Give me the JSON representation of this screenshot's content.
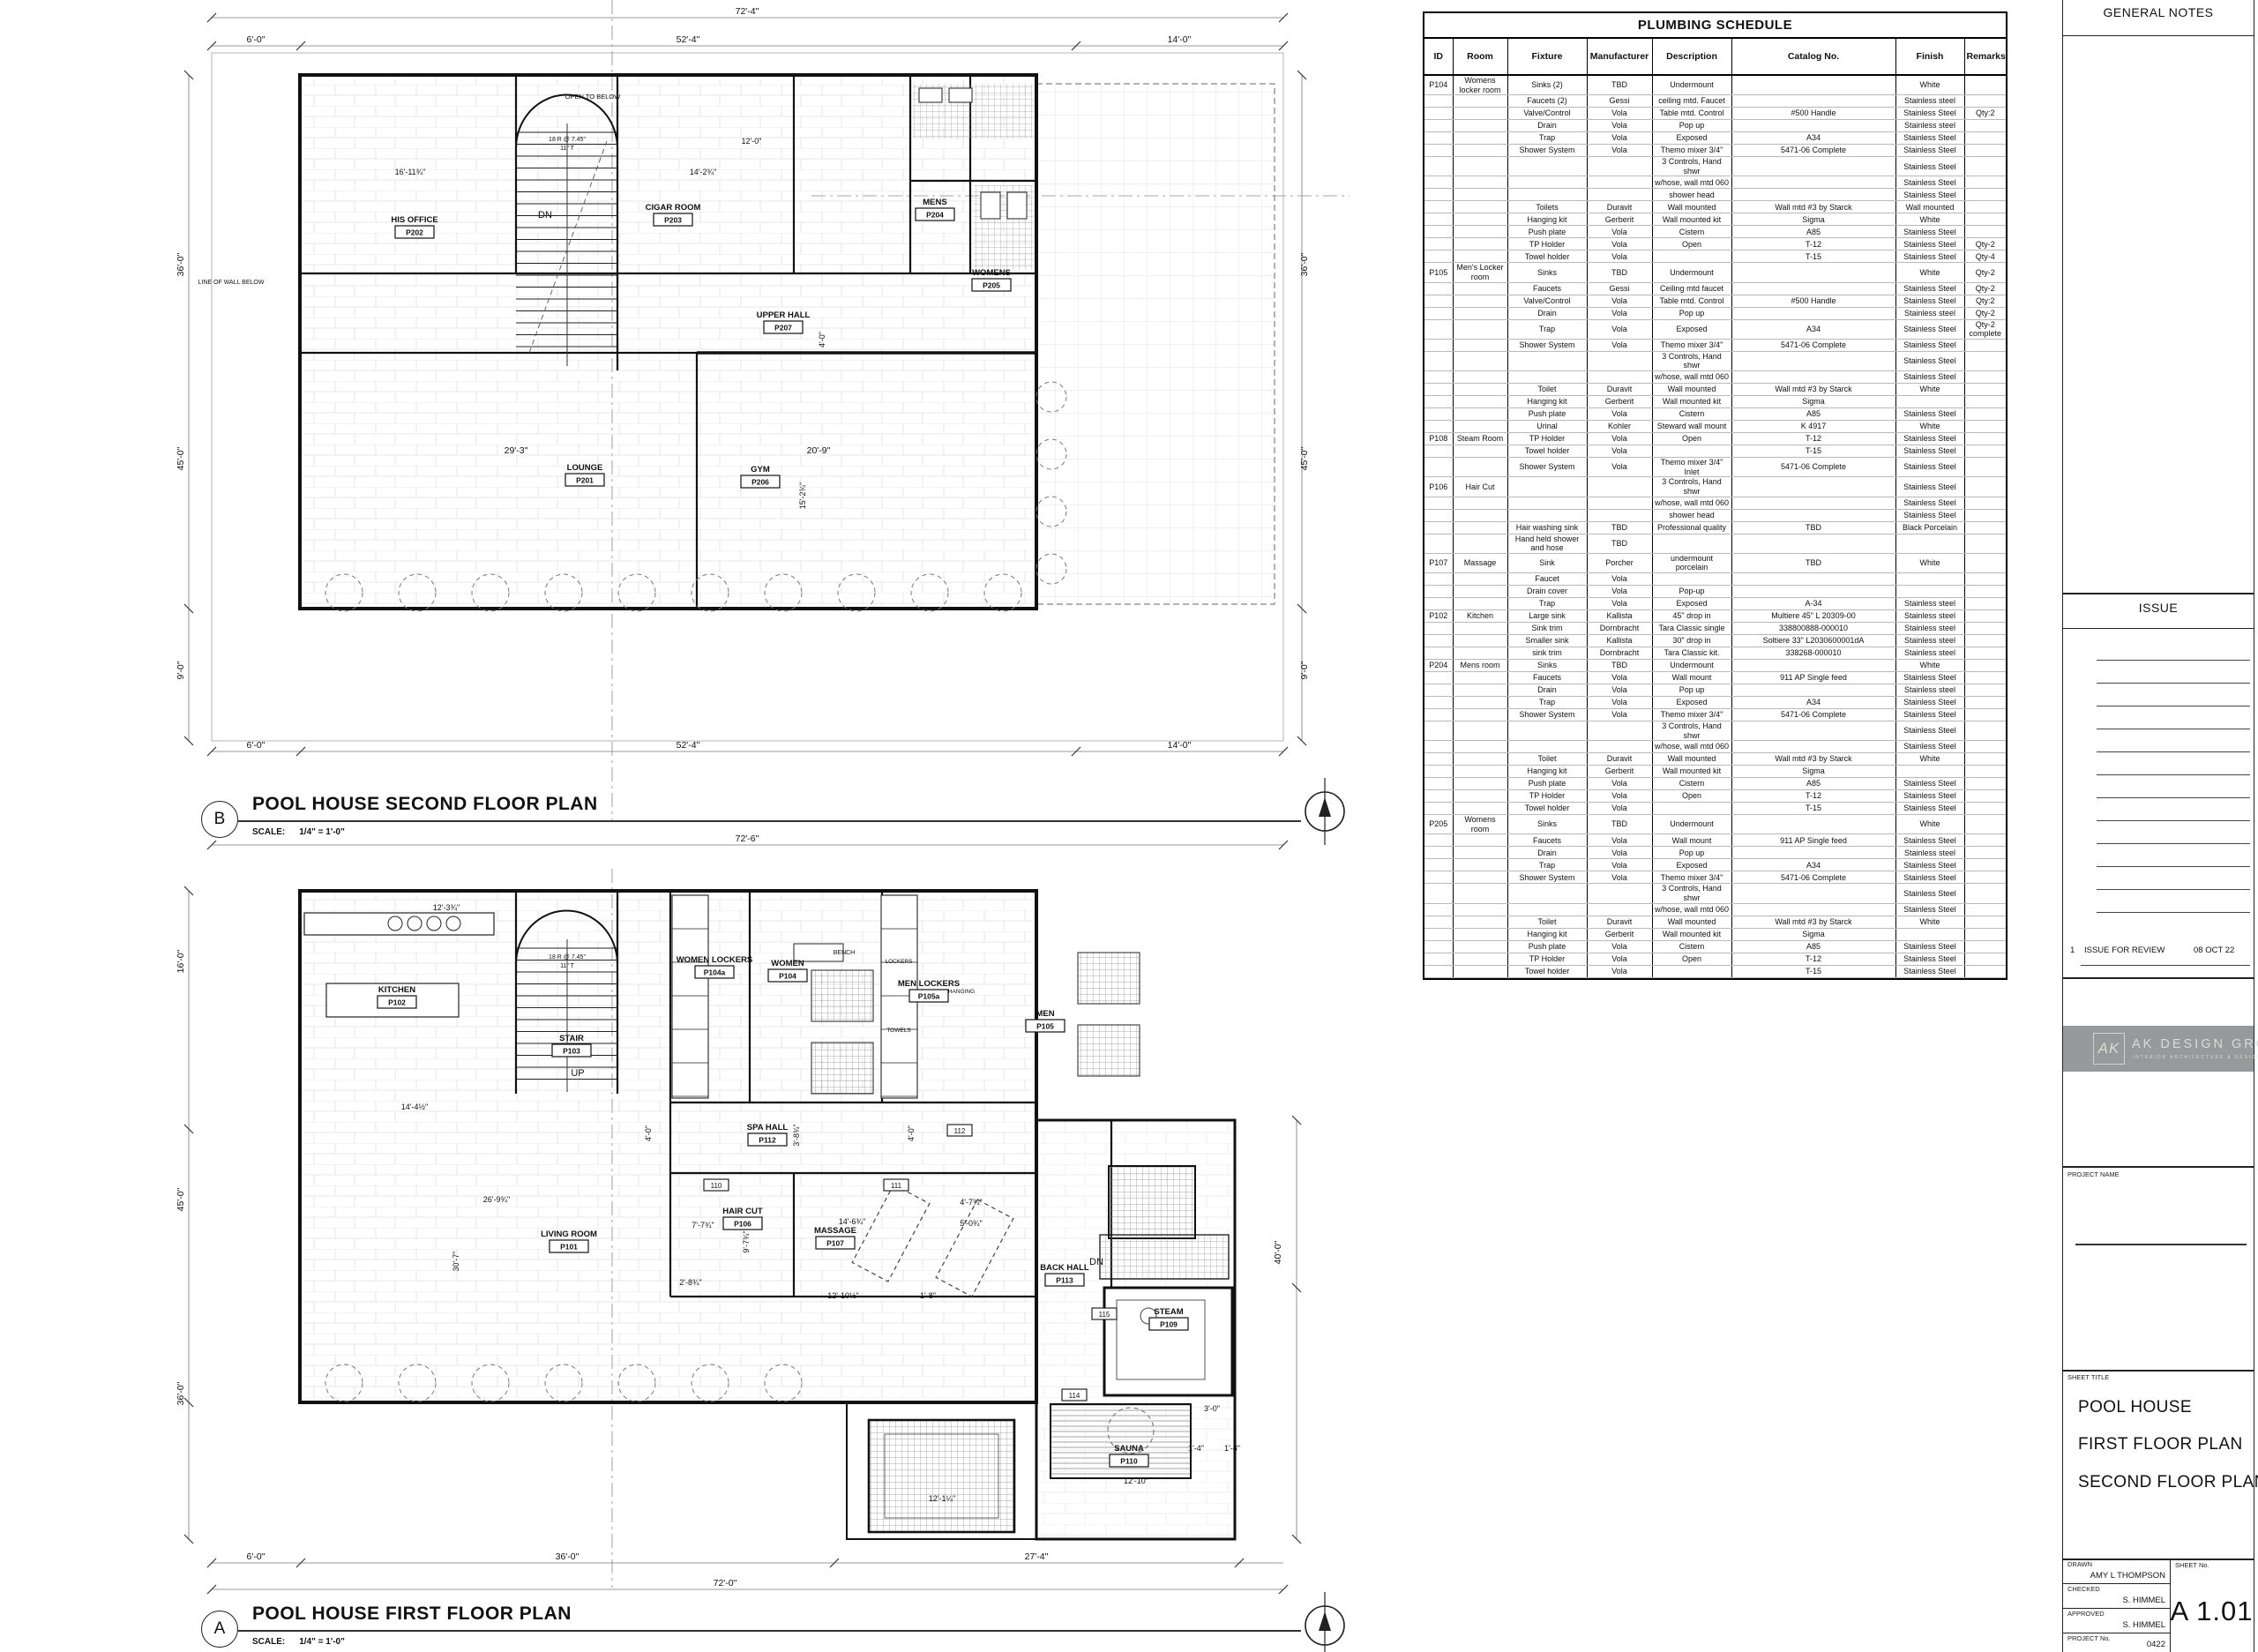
{
  "schedule": {
    "title": "PLUMBING SCHEDULE",
    "columns": [
      "ID",
      "Room",
      "Fixture",
      "Manufacturer",
      "Description",
      "Catalog No.",
      "Finish",
      "Remarks"
    ],
    "rows": [
      {
        "g": 1,
        "id": "P104",
        "room": "Womens locker room",
        "fixture": "Sinks (2)",
        "mfr": "TBD",
        "desc": "Undermount",
        "cat": "",
        "fin": "White",
        "rem": ""
      },
      {
        "fixture": "Faucets (2)",
        "mfr": "Gessi",
        "desc": "ceiling mtd. Faucet",
        "cat": "",
        "fin": "Stainless steel",
        "rem": ""
      },
      {
        "fixture": "Valve/Control",
        "mfr": "Vola",
        "desc": "Table mtd. Control",
        "cat": "#500 Handle",
        "fin": "Stainless Steel",
        "rem": "Qty:2"
      },
      {
        "fixture": "Drain",
        "mfr": "Vola",
        "desc": "Pop up",
        "cat": "",
        "fin": "Stainless steel",
        "rem": ""
      },
      {
        "fixture": "Trap",
        "mfr": "Vola",
        "desc": "Exposed",
        "cat": "A34",
        "fin": "Stainless Steel",
        "rem": ""
      },
      {
        "fixture": "Shower System",
        "mfr": "Vola",
        "desc": "Themo mixer 3/4\"",
        "cat": "5471-06 Complete",
        "fin": "Stainless Steel",
        "rem": ""
      },
      {
        "fixture": "",
        "mfr": "",
        "desc": "3 Controls, Hand shwr",
        "cat": "",
        "fin": "Stainless Steel",
        "rem": ""
      },
      {
        "fixture": "",
        "mfr": "",
        "desc": "w/hose, wall mtd 060",
        "cat": "",
        "fin": "Stainless Steel",
        "rem": ""
      },
      {
        "fixture": "",
        "mfr": "",
        "desc": "shower head",
        "cat": "",
        "fin": "Stainless Steel",
        "rem": ""
      },
      {
        "fixture": "Toilets",
        "mfr": "Duravit",
        "desc": "Wall mounted",
        "cat": "Wall mtd #3 by Starck",
        "fin": "Wall mounted",
        "rem": ""
      },
      {
        "fixture": "Hanging kit",
        "mfr": "Gerberit",
        "desc": "Wall mounted kit",
        "cat": "Sigma",
        "fin": "White",
        "rem": ""
      },
      {
        "fixture": "Push plate",
        "mfr": "Vola",
        "desc": "Cistern",
        "cat": "A85",
        "fin": "Stainless Steel",
        "rem": ""
      },
      {
        "fixture": "TP Holder",
        "mfr": "Vola",
        "desc": "Open",
        "cat": "T-12",
        "fin": "Stainless Steel",
        "rem": "Qty-2"
      },
      {
        "fixture": "Towel holder",
        "mfr": "Vola",
        "desc": "",
        "cat": "T-15",
        "fin": "Stainless Steel",
        "rem": "Qty-4"
      },
      {
        "g": 1,
        "id": "P105",
        "room": "Men's Locker room",
        "fixture": "Sinks",
        "mfr": "TBD",
        "desc": "Undermount",
        "cat": "",
        "fin": "White",
        "rem": "Qty-2"
      },
      {
        "fixture": "Faucets",
        "mfr": "Gessi",
        "desc": "Ceiling mtd faucet",
        "cat": "",
        "fin": "Stainless Steel",
        "rem": "Qty-2"
      },
      {
        "fixture": "Valve/Control",
        "mfr": "Vola",
        "desc": "Table mtd. Control",
        "cat": "#500 Handle",
        "fin": "Stainless Steel",
        "rem": "Qty:2"
      },
      {
        "fixture": "Drain",
        "mfr": "Vola",
        "desc": "Pop up",
        "cat": "",
        "fin": "Stainless steel",
        "rem": "Qty-2"
      },
      {
        "fixture": "Trap",
        "mfr": "Vola",
        "desc": "Exposed",
        "cat": "A34",
        "fin": "Stainless Steel",
        "rem": "Qty-2 complete"
      },
      {
        "fixture": "Shower System",
        "mfr": "Vola",
        "desc": "Themo mixer 3/4\"",
        "cat": "5471-06 Complete",
        "fin": "Stainless Steel",
        "rem": ""
      },
      {
        "fixture": "",
        "mfr": "",
        "desc": "3 Controls, Hand shwr",
        "cat": "",
        "fin": "Stainless Steel",
        "rem": ""
      },
      {
        "fixture": "",
        "mfr": "",
        "desc": "w/hose, wall mtd 060",
        "cat": "",
        "fin": "Stainless Steel",
        "rem": ""
      },
      {
        "fixture": "Toilet",
        "mfr": "Duravit",
        "desc": "Wall mounted",
        "cat": "Wall mtd #3 by Starck",
        "fin": "White",
        "rem": ""
      },
      {
        "fixture": "Hanging kit",
        "mfr": "Gerberit",
        "desc": "Wall mounted kit",
        "cat": "Sigma",
        "fin": "",
        "rem": ""
      },
      {
        "fixture": "Push plate",
        "mfr": "Vola",
        "desc": "Cistern",
        "cat": "A85",
        "fin": "Stainless Steel",
        "rem": ""
      },
      {
        "fixture": "Urinal",
        "mfr": "Kohler",
        "desc": "Steward wall mount",
        "cat": "K 4917",
        "fin": "White",
        "rem": ""
      },
      {
        "g": 1,
        "id": "P108",
        "room": "Steam Room",
        "fixture": "TP Holder",
        "mfr": "Vola",
        "desc": "Open",
        "cat": "T-12",
        "fin": "Stainless Steel",
        "rem": ""
      },
      {
        "fixture": "Towel holder",
        "mfr": "Vola",
        "desc": "",
        "cat": "T-15",
        "fin": "Stainless Steel",
        "rem": ""
      },
      {
        "fixture": "Shower System",
        "mfr": "Vola",
        "desc": "Themo mixer 3/4\" Inlet",
        "cat": "5471-06 Complete",
        "fin": "Stainless Steel",
        "rem": ""
      },
      {
        "g": 1,
        "id": "P106",
        "room": "Hair Cut",
        "fixture": "",
        "mfr": "",
        "desc": "3 Controls, Hand shwr",
        "cat": "",
        "fin": "Stainless Steel",
        "rem": ""
      },
      {
        "fixture": "",
        "mfr": "",
        "desc": "w/hose, wall mtd 060",
        "cat": "",
        "fin": "Stainless Steel",
        "rem": ""
      },
      {
        "fixture": "",
        "mfr": "",
        "desc": "shower head",
        "cat": "",
        "fin": "Stainless Steel",
        "rem": ""
      },
      {
        "fixture": "Hair washing sink",
        "mfr": "TBD",
        "desc": "Professional quality",
        "cat": "TBD",
        "fin": "Black Porcelain",
        "rem": ""
      },
      {
        "fixture": "Hand held shower and hose",
        "mfr": "TBD",
        "desc": "",
        "cat": "",
        "fin": "",
        "rem": ""
      },
      {
        "g": 1,
        "id": "P107",
        "room": "Massage",
        "fixture": "Sink",
        "mfr": "Porcher",
        "desc": "undermount porcelain",
        "cat": "TBD",
        "fin": "White",
        "rem": ""
      },
      {
        "fixture": "Faucet",
        "mfr": "Vola",
        "desc": "",
        "cat": "",
        "fin": "",
        "rem": ""
      },
      {
        "fixture": "Drain cover",
        "mfr": "Vola",
        "desc": "Pop-up",
        "cat": "",
        "fin": "",
        "rem": ""
      },
      {
        "fixture": "Trap",
        "mfr": "Vola",
        "desc": "Exposed",
        "cat": "A-34",
        "fin": "Stainless steel",
        "rem": ""
      },
      {
        "g": 1,
        "id": "P102",
        "room": "Kitchen",
        "fixture": "Large sink",
        "mfr": "Kallista",
        "desc": "45\" drop in",
        "cat": "Multiere 45\" L 20309-00",
        "fin": "Stainless steel",
        "rem": ""
      },
      {
        "fixture": "Sink trim",
        "mfr": "Dornbracht",
        "desc": "Tara Classic single",
        "cat": "338800888-000010",
        "fin": "Stainless steel",
        "rem": ""
      },
      {
        "fixture": "Smaller sink",
        "mfr": "Kallista",
        "desc": "30\" drop in",
        "cat": "Soltiere 33\" L2030600001dA",
        "fin": "Stainless steel",
        "rem": ""
      },
      {
        "fixture": "sink trim",
        "mfr": "Dornbracht",
        "desc": "Tara Classic kit.",
        "cat": "338268-000010",
        "fin": "Stainless steel",
        "rem": ""
      },
      {
        "g": 1,
        "id": "P204",
        "room": "Mens room",
        "fixture": "Sinks",
        "mfr": "TBD",
        "desc": "Undermount",
        "cat": "",
        "fin": "White",
        "rem": ""
      },
      {
        "fixture": "Faucets",
        "mfr": "Vola",
        "desc": "Wall mount",
        "cat": "911 AP Single feed",
        "fin": "Stainless Steel",
        "rem": ""
      },
      {
        "fixture": "Drain",
        "mfr": "Vola",
        "desc": "Pop up",
        "cat": "",
        "fin": "Stainless steel",
        "rem": ""
      },
      {
        "fixture": "Trap",
        "mfr": "Vola",
        "desc": "Exposed",
        "cat": "A34",
        "fin": "Stainless Steel",
        "rem": ""
      },
      {
        "fixture": "Shower System",
        "mfr": "Vola",
        "desc": "Themo mixer 3/4\"",
        "cat": "5471-06 Complete",
        "fin": "Stainless Steel",
        "rem": ""
      },
      {
        "fixture": "",
        "mfr": "",
        "desc": "3 Controls, Hand shwr",
        "cat": "",
        "fin": "Stainless Steel",
        "rem": ""
      },
      {
        "fixture": "",
        "mfr": "",
        "desc": "w/hose, wall mtd 060",
        "cat": "",
        "fin": "Stainless Steel",
        "rem": ""
      },
      {
        "fixture": "Toilet",
        "mfr": "Duravit",
        "desc": "Wall mounted",
        "cat": "Wall mtd #3 by Starck",
        "fin": "White",
        "rem": ""
      },
      {
        "fixture": "Hanging kit",
        "mfr": "Gerberit",
        "desc": "Wall mounted kit",
        "cat": "Sigma",
        "fin": "",
        "rem": ""
      },
      {
        "fixture": "Push plate",
        "mfr": "Vola",
        "desc": "Cistern",
        "cat": "A85",
        "fin": "Stainless Steel",
        "rem": ""
      },
      {
        "fixture": "TP Holder",
        "mfr": "Vola",
        "desc": "Open",
        "cat": "T-12",
        "fin": "Stainless Steel",
        "rem": ""
      },
      {
        "fixture": "Towel holder",
        "mfr": "Vola",
        "desc": "",
        "cat": "T-15",
        "fin": "Stainless Steel",
        "rem": ""
      },
      {
        "g": 1,
        "id": "P205",
        "room": "Womens room",
        "fixture": "Sinks",
        "mfr": "TBD",
        "desc": "Undermount",
        "cat": "",
        "fin": "White",
        "rem": ""
      },
      {
        "fixture": "Faucets",
        "mfr": "Vola",
        "desc": "Wall mount",
        "cat": "911 AP Single feed",
        "fin": "Stainless Steel",
        "rem": ""
      },
      {
        "fixture": "Drain",
        "mfr": "Vola",
        "desc": "Pop up",
        "cat": "",
        "fin": "Stainless steel",
        "rem": ""
      },
      {
        "fixture": "Trap",
        "mfr": "Vola",
        "desc": "Exposed",
        "cat": "A34",
        "fin": "Stainless Steel",
        "rem": ""
      },
      {
        "fixture": "Shower System",
        "mfr": "Vola",
        "desc": "Themo mixer 3/4\"",
        "cat": "5471-06 Complete",
        "fin": "Stainless Steel",
        "rem": ""
      },
      {
        "fixture": "",
        "mfr": "",
        "desc": "3 Controls, Hand shwr",
        "cat": "",
        "fin": "Stainless Steel",
        "rem": ""
      },
      {
        "fixture": "",
        "mfr": "",
        "desc": "w/hose, wall mtd 060",
        "cat": "",
        "fin": "Stainless Steel",
        "rem": ""
      },
      {
        "fixture": "Toilet",
        "mfr": "Duravit",
        "desc": "Wall mounted",
        "cat": "Wall mtd #3 by Starck",
        "fin": "White",
        "rem": ""
      },
      {
        "fixture": "Hanging kit",
        "mfr": "Gerberit",
        "desc": "Wall mounted kit",
        "cat": "Sigma",
        "fin": "",
        "rem": ""
      },
      {
        "fixture": "Push plate",
        "mfr": "Vola",
        "desc": "Cistern",
        "cat": "A85",
        "fin": "Stainless Steel",
        "rem": ""
      },
      {
        "fixture": "TP Holder",
        "mfr": "Vola",
        "desc": "Open",
        "cat": "T-12",
        "fin": "Stainless Steel",
        "rem": ""
      },
      {
        "fixture": "Towel holder",
        "mfr": "Vola",
        "desc": "",
        "cat": "T-15",
        "fin": "Stainless Steel",
        "rem": ""
      }
    ]
  },
  "titleblock": {
    "general_notes_label": "GENERAL NOTES",
    "issue_label": "ISSUE",
    "issue_rows": [
      {
        "no": "1",
        "desc": "ISSUE FOR REVIEW",
        "date": "08 OCT 22"
      }
    ],
    "logo": {
      "monogram": "AK",
      "name": "AK DESIGN GROUP",
      "tagline": "INTERIOR ARCHITECTURE & DESIGN"
    },
    "project_name_label": "PROJECT NAME",
    "sheet_title_label": "SHEET TITLE",
    "sheet_title_lines": [
      "POOL HOUSE",
      "FIRST FLOOR PLAN",
      "SECOND FLOOR PLAN"
    ],
    "drawn_label": "DRAWN",
    "drawn": "AMY L THOMPSON",
    "checked_label": "CHECKED",
    "checked": "S. HIMMEL",
    "approved_label": "APPROVED",
    "approved": "S. HIMMEL",
    "project_no_label": "PROJECT No.",
    "project_no": "0422",
    "sheet_no_label": "SHEET No.",
    "sheet_no": "A 1.01"
  },
  "plans": {
    "second": {
      "tag": "B",
      "title": "POOL HOUSE SECOND FLOOR PLAN",
      "scale_label": "SCALE:",
      "scale": "1/4\" = 1'-0\"",
      "rooms": [
        {
          "name": "HIS OFFICE",
          "tag": "P202"
        },
        {
          "name": "CIGAR ROOM",
          "tag": "P203"
        },
        {
          "name": "UPPER HALL",
          "tag": "P207"
        },
        {
          "name": "LOUNGE",
          "tag": "P201"
        },
        {
          "name": "GYM",
          "tag": "P206"
        },
        {
          "name": "MENS",
          "tag": "P204"
        },
        {
          "name": "WOMENS",
          "tag": "P205"
        }
      ],
      "notes": [
        "OPEN TO BELOW",
        "DN",
        "LINE OF WALL BELOW",
        "18 R @ 7.45\"",
        "11\" T"
      ],
      "dims": [
        "72'-4\"",
        "6'-0\"",
        "52'-4\"",
        "14'-0\"",
        "6'-0\"",
        "52'-4\"",
        "14'-0\"",
        "36'-0\"",
        "45'-0\"",
        "9'-0\"",
        "36'-0\"",
        "45'-0\"",
        "9'-0\"",
        "29'-3\"",
        "20'-9\"",
        "16'-11¾\"",
        "14'-2¾\"",
        "12'-0\"",
        "4'-0\"",
        "15'-2¾\""
      ]
    },
    "first": {
      "tag": "A",
      "title": "POOL HOUSE FIRST FLOOR PLAN",
      "scale_label": "SCALE:",
      "scale": "1/4\" = 1'-0\"",
      "rooms": [
        {
          "name": "KITCHEN",
          "tag": "P102"
        },
        {
          "name": "LIVING ROOM",
          "tag": "P101"
        },
        {
          "name": "STAIR",
          "tag": "P103"
        },
        {
          "name": "WOMEN LOCKERS",
          "tag": "P104a"
        },
        {
          "name": "WOMEN",
          "tag": "P104"
        },
        {
          "name": "MEN LOCKERS",
          "tag": "P105a"
        },
        {
          "name": "MEN",
          "tag": "P105"
        },
        {
          "name": "SPA HALL",
          "tag": "P112"
        },
        {
          "name": "HAIR CUT",
          "tag": "P106"
        },
        {
          "name": "MASSAGE",
          "tag": "P107"
        },
        {
          "name": "BACK HALL",
          "tag": "P113"
        },
        {
          "name": "STEAM",
          "tag": "P109"
        },
        {
          "name": "SAUNA",
          "tag": "P110"
        }
      ],
      "notes": [
        "UP",
        "DN",
        "18 R @ 7.45\"",
        "11\" T",
        "BENCH",
        "LOCKERS",
        "TOWELS",
        "HANGING"
      ],
      "door_tags": [
        "110",
        "111",
        "112",
        "114",
        "115"
      ],
      "dims": [
        "72'-6\"",
        "6'-0\"",
        "36'-0\"",
        "27'-4\"",
        "72'-0\"",
        "16'-0\"",
        "45'-0\"",
        "36'-0\"",
        "40'-0\"",
        "12'-3¾\"",
        "14'-4½\"",
        "26'-9¾\"",
        "30'-7\"",
        "7'-7¾\"",
        "9'-7¾\"",
        "14'-6¾\"",
        "12'-10½\"",
        "1'-8\"",
        "4'-7¾\"",
        "5'-0¾\"",
        "3'-8¾\"",
        "4'-0\"",
        "4'-0\"",
        "2'-8¾\"",
        "3'-0\"",
        "1'-4\"",
        "1'-8\"",
        "12'-10\"",
        "12'-1¼\""
      ]
    }
  }
}
